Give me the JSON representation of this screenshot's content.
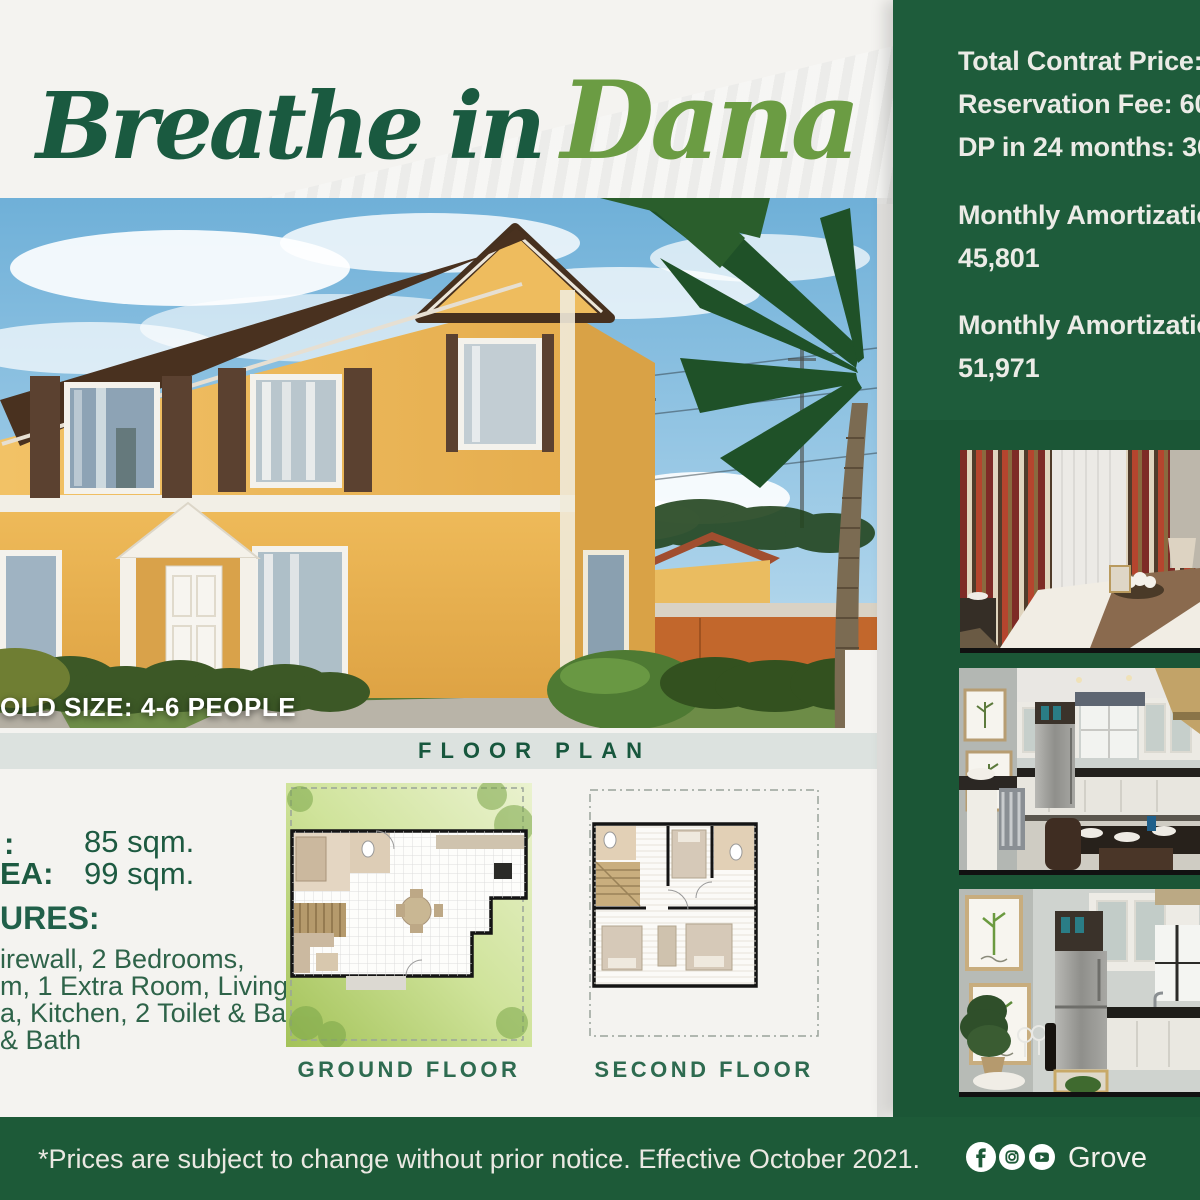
{
  "title": {
    "part1": "Breathe in",
    "part2": "Dana"
  },
  "photo": {
    "household_label": "OLD SIZE: 4-6 PEOPLE"
  },
  "band": {
    "heading": "FLOOR PLAN"
  },
  "specs": {
    "floor_area_label": ":",
    "floor_area_value": "85 sqm.",
    "lot_area_label": "EA:",
    "lot_area_value": "99 sqm.",
    "features_heading": "URES:",
    "features_lines": [
      "irewall, 2 Bedrooms,",
      "m, 1 Extra Room, Living",
      "a, Kitchen, 2 Toilet & Baths,",
      "& Bath"
    ]
  },
  "plans": {
    "ground_label": "GROUND FLOOR",
    "second_label": "SECOND FLOOR"
  },
  "pricing": {
    "tcp": "Total Contrat Price:",
    "rf": "Reservation Fee: 60",
    "dp": "DP in 24 months: 36",
    "ma1_label": "Monthly Amortizatio",
    "ma1_value": "45,801",
    "ma2_label": "Monthly Amortizatio",
    "ma2_value": "51,971"
  },
  "footer": {
    "disclaimer": "*Prices are subject to change without prior notice. Effective October 2021.",
    "handle": "Grove",
    "social_icons": [
      "facebook-icon",
      "instagram-icon",
      "youtube-icon"
    ]
  },
  "colors": {
    "panel_green": "#1e5c3b",
    "footer_green": "#1d5a38",
    "title_green": "#1a5a40",
    "title_light_green": "#6b9c43",
    "heading_green": "#17573d",
    "band_gray": "#dce2df"
  }
}
